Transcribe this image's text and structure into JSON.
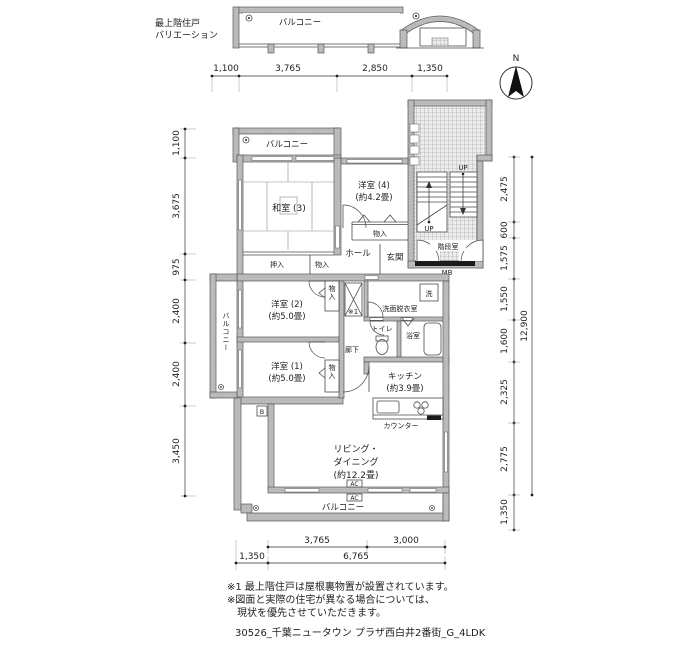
{
  "header": {
    "variation_line1": "最上階住戸",
    "variation_line2": "バリエーション",
    "variation_balcony": "バルコニー"
  },
  "compass": {
    "north": "N"
  },
  "plan": {
    "balcony_top": "バルコニー",
    "balcony_left": "バルコニー",
    "balcony_bottom": "バルコニー",
    "washitsu3": "和室 (3)",
    "yoshitsu4_name": "洋室 (4)",
    "yoshitsu4_size": "(約4.2畳)",
    "yoshitsu2_name": "洋室 (2)",
    "yoshitsu2_size": "(約5.0畳)",
    "yoshitsu1_name": "洋室 (1)",
    "yoshitsu1_size": "(約5.0畳)",
    "kitchen_name": "キッチン",
    "kitchen_size": "(約3.9畳)",
    "living_line1": "リビング・",
    "living_line2": "ダイニング",
    "living_line3": "(約12.2畳)",
    "hall": "ホール",
    "genkan": "玄関",
    "oshiire": "押入",
    "monoiri_hall": "物入",
    "monoiri_a": "物入",
    "monoiri_r2": "物入",
    "monoiri_r1": "物入",
    "kaidan": "階段室",
    "mb": "MB",
    "up_upper": "UP",
    "up_lower": "UP",
    "senmen": "洗面脱衣室",
    "washer": "洗",
    "toilet": "トイレ",
    "bath": "浴室",
    "rouka": "廊下",
    "counter": "カウンター",
    "shaft_note": "※1",
    "ac1": "AC",
    "ac2": "AC",
    "marker_b": "B"
  },
  "dimensions": {
    "top": [
      "1,100",
      "3,765",
      "2,850",
      "1,350"
    ],
    "left": [
      "1,100",
      "3,675",
      "975",
      "2,400",
      "2,400",
      "3,450"
    ],
    "right": [
      "2,475",
      "600",
      "1,575",
      "1,550",
      "1,600",
      "2,325",
      "2,775",
      "1,350"
    ],
    "right_total": "12,900",
    "bottom_upper": [
      "3,765",
      "3,000"
    ],
    "bottom_lower": [
      "1,350",
      "6,765"
    ]
  },
  "notes": {
    "line1": "※1 最上階住戸は屋根裏物置が設置されています。",
    "line2": "※図面と実際の住宅が異なる場合については、",
    "line3": "現状を優先させていただきます。",
    "footer": "30526_千葉ニュータウン プラザ西白井2番街_G_4LDK"
  }
}
